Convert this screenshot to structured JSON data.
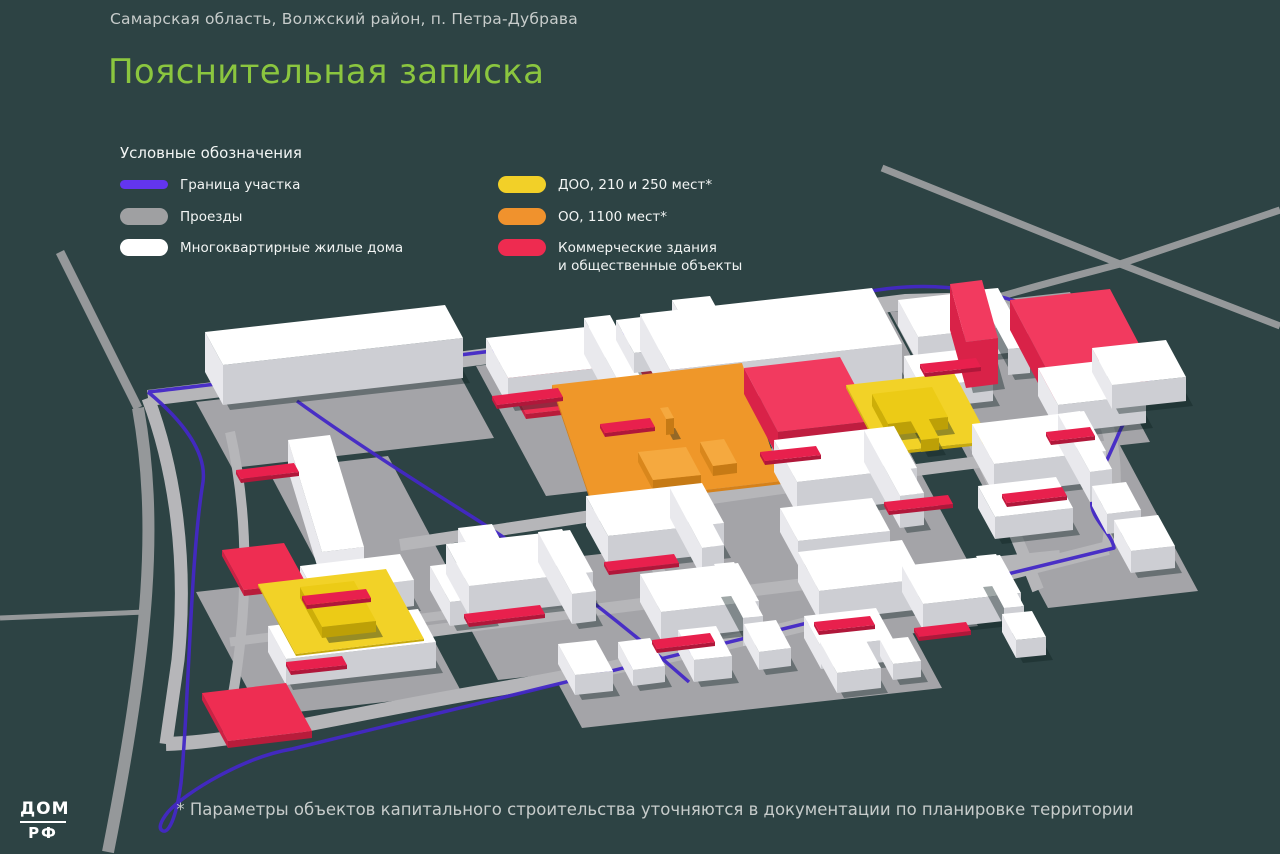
{
  "page": {
    "bg": "#2d4344",
    "text_light": "#c7cccb",
    "text_white": "#f2f5f4"
  },
  "header": {
    "location": "Самарская область, Волжский район, п. Петра-Дубрава",
    "title": "Пояснительная записка",
    "title_color": "#8bc63f"
  },
  "legend": {
    "heading": "Условные обозначения",
    "items": [
      {
        "label": "Граница участка",
        "color": "#6335ef",
        "shape": "line",
        "col": 0
      },
      {
        "label": "Проезды",
        "color": "#9fa0a2",
        "shape": "pill",
        "col": 0
      },
      {
        "label": "Многоквартирные жилые дома",
        "color": "#ffffff",
        "shape": "pill",
        "col": 0
      },
      {
        "label": "ДОО, 210 и 250 мест*",
        "color": "#f2d028",
        "shape": "pill",
        "col": 1
      },
      {
        "label": "ОО, 1100 мест*",
        "color": "#f0922d",
        "shape": "pill",
        "col": 1
      },
      {
        "label": "Коммерческие здания\nи общественные объекты",
        "color": "#ee2b50",
        "shape": "pill",
        "col": 1
      }
    ]
  },
  "footer": {
    "note": "* Параметры объектов капитального строительства уточняются в документации по планировке территории"
  },
  "logo": {
    "top": "ДОМ",
    "bottom": "РФ"
  },
  "map": {
    "colors": {
      "background": "#2d4344",
      "offsite_road": "#95989a",
      "road": "#b6b6b9",
      "platform": "#a4a4a8",
      "boundary": "#4328c6",
      "shadow": "rgba(16,34,36,0.4)"
    },
    "palette": {
      "w": {
        "t": "#ffffff",
        "l": "#e9e9ed",
        "d": "#cdced3"
      },
      "r": {
        "t": "#f23a5f",
        "l": "#d92248",
        "d": "#bf1d3f"
      },
      "R": {
        "t": "#ee2d52",
        "l": "#cc2144",
        "d": "#b81c3b"
      },
      "o": {
        "t": "#f5a93f",
        "l": "#d9871c",
        "d": "#c67a15"
      },
      "O": {
        "t": "#ef9729",
        "l": "#d5811a",
        "d": "#c47314"
      },
      "y": {
        "t": "#eccb16",
        "l": "#cdae08",
        "d": "#bda007"
      },
      "Y": {
        "t": "#f2d227",
        "l": "#d4b613",
        "d": "#c6a90f"
      },
      "s": {
        "t": "#e8204d",
        "l": "#c51a40",
        "d": "#b0173a"
      },
      "g": {
        "t": "#a4a4a8",
        "l": "#9a9a9e",
        "d": "#939397"
      }
    },
    "offsite_roads": [
      {
        "d": "M60,252 L138,408",
        "w": 9
      },
      {
        "d": "M138,408 C158,520 150,640 108,852",
        "w": 12
      },
      {
        "d": "M0,618 L146,612",
        "w": 5
      },
      {
        "d": "M882,168 L1120,264 L1280,326",
        "w": 7
      },
      {
        "d": "M988,300 C1050,282 1090,272 1120,264 L1280,210",
        "w": 7
      }
    ],
    "grounds": [
      [
        196,
        402,
        262,
        -30,
        36,
        66
      ],
      [
        268,
        470,
        120,
        -14,
        90,
        170
      ],
      [
        256,
        652,
        170,
        -19,
        24,
        44
      ],
      [
        196,
        592,
        200,
        -23,
        66,
        124
      ],
      [
        476,
        366,
        150,
        -17,
        70,
        130
      ],
      [
        632,
        330,
        250,
        -28,
        44,
        82
      ],
      [
        890,
        312,
        180,
        -20,
        80,
        150
      ],
      [
        958,
        440,
        150,
        -17,
        90,
        168
      ],
      [
        580,
        470,
        320,
        -36,
        80,
        150
      ],
      [
        440,
        572,
        480,
        -54,
        58,
        108
      ],
      [
        540,
        650,
        360,
        -40,
        42,
        78
      ]
    ],
    "roads": [
      {
        "d": "M148,398 C400,368 700,330 905,302 L990,300",
        "w": 16
      },
      {
        "d": "M148,398 C175,470 188,560 178,660 L166,744",
        "w": 13
      },
      {
        "d": "M166,744 C240,742 340,716 480,692 C700,656 900,600 1108,548",
        "w": 14
      },
      {
        "d": "M990,300 C1040,330 1090,380 1108,430 C1120,470 1112,520 1108,548",
        "w": 13
      },
      {
        "d": "M560,352 C600,430 640,520 686,640",
        "w": 12
      },
      {
        "d": "M742,366 C780,450 820,540 862,642",
        "w": 12
      },
      {
        "d": "M905,303 C945,380 990,470 1038,590",
        "w": 12
      },
      {
        "d": "M400,545 C600,515 800,482 1112,446",
        "w": 12
      },
      {
        "d": "M300,648 C560,614 820,580 1060,556",
        "w": 12
      },
      {
        "d": "M230,432 C250,520 248,610 232,700",
        "w": 10
      },
      {
        "d": "M230,642 C330,630 420,618 470,612",
        "w": 9
      },
      {
        "d": "M1060,312 C1075,345 1088,360 1096,372",
        "w": 9
      }
    ],
    "boundary": [
      {
        "d": "M148,392 C300,374 520,350 700,322 C760,312 830,296 885,289 C940,282 990,291 1032,307 C1075,324 1135,352 1149,371 C1158,384 1128,410 1119,433 C1107,461 1097,479 1092,501 C1089,517 1112,533 1114,548 L292,749 C244,757 186,792 168,812 C160,822 158,829 163,831 C170,833 177,813 181,783 C189,703 190,562 203,482 C207,452 182,420 148,392"
      },
      {
        "d": "M297,401 C345,436 420,484 471,516 C525,550 610,612 689,682"
      }
    ],
    "bars": [
      [
        506,
        382,
        180,
        -20,
        20,
        37,
        5,
        "R"
      ],
      [
        205,
        372,
        240,
        -27,
        18,
        33,
        40,
        "w"
      ],
      [
        288,
        470,
        34,
        112,
        42,
        -5,
        30,
        "w"
      ],
      [
        300,
        592,
        100,
        -12,
        14,
        26,
        26,
        "w"
      ],
      [
        430,
        590,
        42,
        -5,
        20,
        36,
        24,
        "w"
      ],
      [
        458,
        546,
        34,
        -4,
        16,
        30,
        18,
        "w"
      ],
      [
        268,
        652,
        150,
        -17,
        18,
        33,
        26,
        "w"
      ],
      [
        222,
        556,
        62,
        -7,
        22,
        40,
        6,
        "R"
      ],
      [
        258,
        586,
        128,
        -15,
        38,
        70,
        2,
        "Y"
      ],
      [
        300,
        598,
        54,
        -6,
        22,
        40,
        11,
        "y"
      ],
      [
        202,
        700,
        84,
        -10,
        26,
        48,
        7,
        "R"
      ],
      [
        486,
        366,
        118,
        -13,
        22,
        40,
        28,
        "w"
      ],
      [
        584,
        354,
        26,
        -3,
        40,
        74,
        36,
        "w"
      ],
      [
        616,
        340,
        42,
        -5,
        18,
        33,
        20,
        "w"
      ],
      [
        672,
        330,
        38,
        -4,
        17,
        31,
        30,
        "w"
      ],
      [
        640,
        350,
        232,
        -26,
        30,
        56,
        36,
        "w"
      ],
      [
        898,
        326,
        98,
        -11,
        20,
        37,
        26,
        "w"
      ],
      [
        976,
        316,
        22,
        -2,
        32,
        59,
        26,
        "w"
      ],
      [
        904,
        378,
        72,
        -8,
        17,
        31,
        22,
        "w"
      ],
      [
        950,
        330,
        32,
        -4,
        16,
        58,
        46,
        "r"
      ],
      [
        1010,
        330,
        100,
        -11,
        38,
        72,
        30,
        "r"
      ],
      [
        1038,
        396,
        88,
        -10,
        20,
        37,
        28,
        "w"
      ],
      [
        1092,
        372,
        74,
        -8,
        20,
        37,
        24,
        "w"
      ],
      [
        552,
        388,
        190,
        -22,
        40,
        118,
        3,
        "O"
      ],
      [
        638,
        462,
        48,
        -5,
        15,
        28,
        10,
        "o"
      ],
      [
        700,
        452,
        24,
        -3,
        13,
        24,
        10,
        "o"
      ],
      [
        660,
        424,
        8,
        -1,
        6,
        11,
        16,
        "o"
      ],
      [
        744,
        394,
        96,
        -11,
        34,
        64,
        26,
        "r"
      ],
      [
        846,
        388,
        108,
        -12,
        36,
        68,
        3,
        "Y"
      ],
      [
        872,
        406,
        60,
        -7,
        16,
        30,
        12,
        "y"
      ],
      [
        908,
        428,
        18,
        -2,
        13,
        24,
        12,
        "y"
      ],
      [
        586,
        526,
        116,
        -13,
        22,
        40,
        30,
        "w"
      ],
      [
        670,
        518,
        22,
        -3,
        32,
        60,
        30,
        "w"
      ],
      [
        774,
        472,
        120,
        -14,
        23,
        42,
        32,
        "w"
      ],
      [
        864,
        462,
        24,
        -3,
        36,
        66,
        32,
        "w"
      ],
      [
        780,
        532,
        92,
        -10,
        18,
        33,
        24,
        "w"
      ],
      [
        972,
        454,
        112,
        -13,
        22,
        40,
        30,
        "w"
      ],
      [
        1058,
        444,
        22,
        -3,
        32,
        58,
        30,
        "w"
      ],
      [
        978,
        508,
        78,
        -9,
        17,
        31,
        22,
        "w"
      ],
      [
        1092,
        506,
        34,
        -4,
        15,
        28,
        20,
        "w"
      ],
      [
        1114,
        542,
        44,
        -5,
        17,
        31,
        22,
        "w"
      ],
      [
        446,
        574,
        124,
        -14,
        23,
        42,
        30,
        "w"
      ],
      [
        538,
        562,
        24,
        -3,
        34,
        62,
        30,
        "w"
      ],
      [
        640,
        602,
        98,
        -11,
        21,
        38,
        28,
        "w"
      ],
      [
        714,
        592,
        20,
        -2,
        29,
        54,
        28,
        "w"
      ],
      [
        798,
        582,
        104,
        -12,
        21,
        39,
        30,
        "w"
      ],
      [
        804,
        638,
        72,
        -8,
        17,
        31,
        22,
        "w"
      ],
      [
        558,
        664,
        38,
        -4,
        17,
        31,
        20,
        "w"
      ],
      [
        618,
        658,
        32,
        -4,
        15,
        28,
        16,
        "w"
      ],
      [
        678,
        652,
        38,
        -4,
        16,
        30,
        22,
        "w"
      ],
      [
        744,
        642,
        32,
        -4,
        15,
        28,
        18,
        "w"
      ],
      [
        902,
        592,
        98,
        -11,
        21,
        38,
        26,
        "w"
      ],
      [
        976,
        582,
        20,
        -2,
        28,
        52,
        26,
        "w"
      ],
      [
        1002,
        632,
        30,
        -3,
        14,
        26,
        18,
        "w"
      ],
      [
        820,
        662,
        44,
        -5,
        17,
        31,
        20,
        "w"
      ],
      [
        880,
        656,
        28,
        -3,
        13,
        24,
        16,
        "w"
      ]
    ],
    "strips": [
      [
        236,
        474,
        58,
        -7
      ],
      [
        302,
        600,
        64,
        -7
      ],
      [
        286,
        666,
        56,
        -6
      ],
      [
        492,
        400,
        66,
        -8
      ],
      [
        600,
        428,
        50,
        -6
      ],
      [
        920,
        368,
        56,
        -6
      ],
      [
        760,
        456,
        56,
        -6
      ],
      [
        884,
        506,
        64,
        -7
      ],
      [
        1002,
        498,
        60,
        -7
      ],
      [
        604,
        566,
        70,
        -8
      ],
      [
        464,
        618,
        76,
        -9
      ],
      [
        652,
        644,
        58,
        -7
      ],
      [
        814,
        626,
        56,
        -6
      ],
      [
        914,
        632,
        52,
        -6
      ],
      [
        1046,
        436,
        44,
        -5
      ]
    ]
  }
}
